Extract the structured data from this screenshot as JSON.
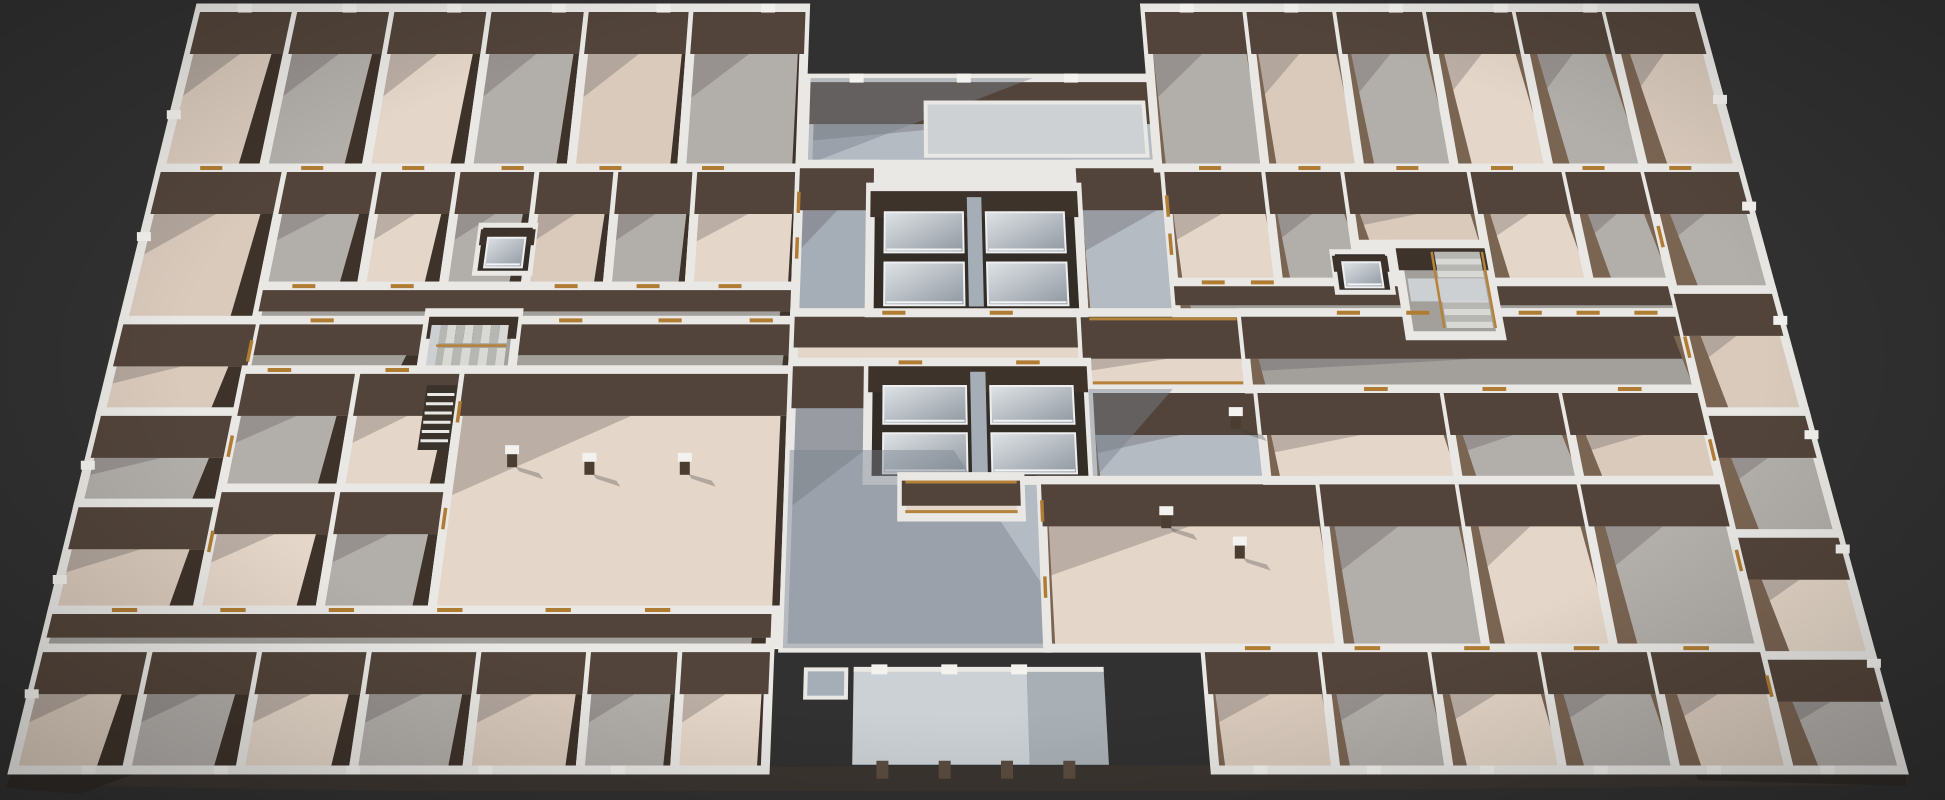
{
  "meta": {
    "view": "3d-floorplan-render",
    "width": 1945,
    "height": 800
  },
  "colors": {
    "bg": "#313131",
    "band": "#e9e8e5",
    "bandBright": "#f3f2ef",
    "slab": "#3b3530",
    "slabDark": "#2e2a26",
    "faceN": "#52443a",
    "faceNDark": "#3d332b",
    "sideL": "#3e332b",
    "sideR": "#7a6452",
    "beige": "#d9cabc",
    "beigeL": "#e4d6c8",
    "gray": "#b2aeaa",
    "grayD": "#a3a09c",
    "lobby": "#b4bbc2",
    "lobbyD": "#a5adb6",
    "sky": "#cdd1d4",
    "canopy": "#ccd1d5",
    "shaft": "#332d28",
    "rail": "#b5823b",
    "oak": "#b07c33",
    "step1": "#d8d8d5",
    "step2": "#b6b6b3",
    "landing": "#cdd0d2",
    "colFace": "#4a3e33",
    "shadow": "rgba(88,82,86,0.30)",
    "lobbyShadow": "rgba(122,130,143,0.45)"
  },
  "proj": {
    "topLeftX": 200,
    "topRightX": 1695,
    "botLeftX": 13,
    "botRightX": 1903,
    "topY": 8,
    "botY": 770,
    "wallH": 42,
    "shearCx": 965,
    "shearK": 0.035,
    "band": 9
  },
  "elements": [
    {
      "t": "spoly",
      "n": "floor-slab-side",
      "f": "slab",
      "pts": [
        [
          13,
          770
        ],
        [
          958,
          766
        ],
        [
          1903,
          763
        ],
        [
          1908,
          785
        ],
        [
          1210,
          791
        ],
        [
          400,
          791
        ],
        [
          12,
          785
        ]
      ]
    },
    {
      "t": "spoly",
      "n": "floor-slab-side-right",
      "f": "slabDark",
      "pts": [
        [
          1690,
          758
        ],
        [
          1903,
          763
        ],
        [
          1907,
          786
        ],
        [
          1698,
          780
        ]
      ]
    },
    {
      "t": "spoly",
      "n": "floor-slab-side-left",
      "f": "slabDark",
      "pts": [
        [
          13,
          768
        ],
        [
          150,
          768
        ],
        [
          80,
          794
        ],
        [
          6,
          788
        ]
      ]
    },
    {
      "t": "fpoly",
      "n": "building-footprint",
      "pts": [
        [
          0,
          0
        ],
        [
          40.5,
          0
        ],
        [
          40.5,
          9.2
        ],
        [
          63.2,
          9.2
        ],
        [
          63.2,
          0
        ],
        [
          100,
          0
        ],
        [
          100,
          100
        ],
        [
          63.6,
          100
        ],
        [
          63.6,
          84
        ],
        [
          39.8,
          84
        ],
        [
          39.8,
          100
        ],
        [
          0,
          100
        ]
      ]
    },
    {
      "t": "room",
      "n": "courtyard",
      "r": [
        41,
        9.2,
        63.2,
        20.5
      ],
      "f": "lobby"
    },
    {
      "t": "shade",
      "n": "courtyard-shadow",
      "pts": [
        [
          41,
          9.2
        ],
        [
          55.5,
          9.2
        ],
        [
          41,
          20.5
        ]
      ],
      "f": "lobbyShadow"
    },
    {
      "t": "rect",
      "n": "courtyard-skylight",
      "r": [
        48.5,
        12.4,
        62.6,
        19.4
      ],
      "f": "sky",
      "ring": 4
    },
    {
      "t": "room",
      "n": "room",
      "r": [
        0,
        0,
        6.5,
        21
      ],
      "f": "beige"
    },
    {
      "t": "room",
      "n": "room",
      "r": [
        6.5,
        0,
        13,
        21
      ],
      "f": "gray"
    },
    {
      "t": "room",
      "n": "room",
      "r": [
        13,
        0,
        19.5,
        21
      ],
      "f": "beigeL"
    },
    {
      "t": "room",
      "n": "room",
      "r": [
        19.5,
        0,
        26,
        21
      ],
      "f": "gray"
    },
    {
      "t": "room",
      "n": "room",
      "r": [
        26,
        0,
        33,
        21
      ],
      "f": "beige"
    },
    {
      "t": "room",
      "n": "room",
      "r": [
        33,
        0,
        40.5,
        21
      ],
      "f": "gray"
    },
    {
      "t": "room",
      "n": "room",
      "r": [
        0,
        21,
        8,
        41
      ],
      "f": "beige"
    },
    {
      "t": "room",
      "n": "room",
      "r": [
        8,
        21,
        14,
        36.5
      ],
      "f": "gray"
    },
    {
      "t": "room",
      "n": "room",
      "r": [
        14,
        21,
        19,
        36.5
      ],
      "f": "beigeL"
    },
    {
      "t": "room",
      "n": "room",
      "r": [
        19,
        21,
        24,
        36.5
      ],
      "f": "gray"
    },
    {
      "t": "room",
      "n": "room",
      "r": [
        24,
        21,
        29,
        36.5
      ],
      "f": "beige"
    },
    {
      "t": "room",
      "n": "room",
      "r": [
        29,
        21,
        34,
        36.5
      ],
      "f": "gray"
    },
    {
      "t": "room",
      "n": "room",
      "r": [
        34,
        21,
        40.5,
        36.5
      ],
      "f": "beigeL"
    },
    {
      "t": "room",
      "n": "corridor",
      "r": [
        8,
        36.5,
        40.5,
        41
      ],
      "f": "grayD"
    },
    {
      "t": "room",
      "n": "corridor",
      "r": [
        8,
        41,
        18.4,
        47.5
      ],
      "f": "grayD"
    },
    {
      "t": "room",
      "n": "corridor",
      "r": [
        23.8,
        41,
        40.5,
        47.5
      ],
      "f": "grayD"
    },
    {
      "t": "stairs",
      "n": "stairwell-west",
      "r": [
        18.4,
        40,
        23.8,
        48
      ],
      "dir": "EW"
    },
    {
      "t": "elev",
      "n": "elevator-west",
      "r": [
        20.8,
        28.5,
        24.2,
        34.8
      ]
    },
    {
      "t": "room",
      "n": "room",
      "r": [
        0,
        41,
        8,
        53
      ],
      "f": "beige"
    },
    {
      "t": "room",
      "n": "room",
      "r": [
        0,
        53,
        8,
        65
      ],
      "f": "gray"
    },
    {
      "t": "room",
      "n": "room",
      "r": [
        0,
        65,
        8,
        79
      ],
      "f": "beige"
    },
    {
      "t": "room",
      "n": "room",
      "r": [
        8,
        47.5,
        14.8,
        63
      ],
      "f": "gray"
    },
    {
      "t": "room",
      "n": "room",
      "r": [
        14.8,
        47.5,
        21,
        63
      ],
      "f": "beigeL"
    },
    {
      "t": "room",
      "n": "room",
      "r": [
        8,
        63,
        14.8,
        79
      ],
      "f": "beigeL"
    },
    {
      "t": "room",
      "n": "room",
      "r": [
        14.8,
        63,
        21,
        79
      ],
      "f": "gray"
    },
    {
      "t": "room",
      "n": "open-plan-room-west",
      "r": [
        21,
        47.5,
        40.5,
        79
      ],
      "f": "beigeL"
    },
    {
      "t": "ladder",
      "n": "service-shaft",
      "r": [
        18.9,
        49.5,
        20.7,
        58
      ]
    },
    {
      "t": "room",
      "n": "corridor",
      "r": [
        0,
        79,
        39.8,
        84
      ],
      "f": "grayD"
    },
    {
      "t": "room",
      "n": "room",
      "r": [
        0,
        84,
        6,
        100
      ],
      "f": "beige"
    },
    {
      "t": "room",
      "n": "room",
      "r": [
        6,
        84,
        12,
        100
      ],
      "f": "gray"
    },
    {
      "t": "room",
      "n": "room",
      "r": [
        12,
        84,
        18,
        100
      ],
      "f": "beigeL"
    },
    {
      "t": "room",
      "n": "room",
      "r": [
        18,
        84,
        24,
        100
      ],
      "f": "gray"
    },
    {
      "t": "room",
      "n": "room",
      "r": [
        24,
        84,
        30,
        100
      ],
      "f": "beige"
    },
    {
      "t": "room",
      "n": "room",
      "r": [
        30,
        84,
        35,
        100
      ],
      "f": "gray"
    },
    {
      "t": "room",
      "n": "room",
      "r": [
        35,
        84,
        39.8,
        100
      ],
      "f": "beigeL"
    },
    {
      "t": "room",
      "n": "lobby-strip-west",
      "r": [
        40.5,
        20.5,
        45.2,
        40
      ],
      "f": "lobbyD"
    },
    {
      "t": "room",
      "n": "lobby-strip-east",
      "r": [
        58,
        20.5,
        67.5,
        40
      ],
      "f": "lobby"
    },
    {
      "t": "room",
      "n": "core-corridor",
      "r": [
        40.5,
        40,
        57.8,
        46.5
      ],
      "f": "beigeL"
    },
    {
      "t": "room",
      "n": "bridge-corridor",
      "r": [
        57.8,
        40,
        67.5,
        50
      ],
      "f": "beigeL"
    },
    {
      "t": "core",
      "n": "elevator-core-north",
      "r": [
        45,
        23.5,
        58,
        40
      ]
    },
    {
      "t": "room",
      "n": "lobby-main",
      "r": [
        40.5,
        46.5,
        55,
        84
      ],
      "f": "lobby"
    },
    {
      "t": "room",
      "n": "lobby-east-pool",
      "r": [
        58,
        50,
        68,
        62
      ],
      "f": "lobby"
    },
    {
      "t": "core",
      "n": "elevator-core-south",
      "r": [
        45,
        46.5,
        58,
        62
      ]
    },
    {
      "t": "shade",
      "n": "lobby-shadow",
      "pts": [
        [
          40.5,
          58
        ],
        [
          50,
          58
        ],
        [
          57,
          84
        ],
        [
          40.5,
          84
        ]
      ],
      "f": "lobbyShadow"
    },
    {
      "t": "shade",
      "n": "lobby-shadow-2",
      "pts": [
        [
          58,
          50
        ],
        [
          63,
          50
        ],
        [
          58,
          62
        ]
      ],
      "f": "lobbyShadow"
    },
    {
      "t": "room",
      "n": "walkway",
      "r": [
        47,
        61.5,
        53.8,
        66.8
      ],
      "f": "beigeL"
    },
    {
      "t": "room",
      "n": "open-plan-room-center",
      "r": [
        55,
        62,
        71,
        84
      ],
      "f": "beigeL"
    },
    {
      "t": "room",
      "n": "room",
      "r": [
        63.2,
        0,
        70,
        21
      ],
      "f": "gray"
    },
    {
      "t": "room",
      "n": "room",
      "r": [
        70,
        0,
        76,
        21
      ],
      "f": "beige"
    },
    {
      "t": "room",
      "n": "room",
      "r": [
        76,
        0,
        82,
        21
      ],
      "f": "gray"
    },
    {
      "t": "room",
      "n": "room",
      "r": [
        82,
        0,
        88,
        21
      ],
      "f": "beigeL"
    },
    {
      "t": "room",
      "n": "room",
      "r": [
        88,
        0,
        94,
        21
      ],
      "f": "gray"
    },
    {
      "t": "room",
      "n": "room",
      "r": [
        94,
        0,
        100,
        21
      ],
      "f": "beige"
    },
    {
      "t": "room",
      "n": "room",
      "r": [
        63.6,
        21,
        70,
        36
      ],
      "f": "beigeL"
    },
    {
      "t": "room",
      "n": "room",
      "r": [
        70,
        21,
        75,
        36
      ],
      "f": "gray"
    },
    {
      "t": "room",
      "n": "room",
      "r": [
        75,
        21,
        83,
        31
      ],
      "f": "beige"
    },
    {
      "t": "room",
      "n": "room",
      "r": [
        83,
        21,
        89,
        36
      ],
      "f": "beigeL"
    },
    {
      "t": "room",
      "n": "room",
      "r": [
        89,
        21,
        94,
        36
      ],
      "f": "gray"
    },
    {
      "t": "room",
      "n": "corridor",
      "r": [
        63.6,
        36,
        94,
        40
      ],
      "f": "grayD"
    },
    {
      "t": "room",
      "n": "corridor",
      "r": [
        67.5,
        40,
        94,
        50
      ],
      "f": "grayD"
    },
    {
      "t": "stairs",
      "n": "stairwell-east",
      "r": [
        77.5,
        31,
        83,
        43
      ],
      "dir": "NS"
    },
    {
      "t": "elev",
      "n": "elevator-east",
      "r": [
        73.5,
        32,
        76.9,
        37.3
      ]
    },
    {
      "t": "room",
      "n": "room",
      "r": [
        94,
        21,
        100,
        37
      ],
      "f": "gray"
    },
    {
      "t": "room",
      "n": "room",
      "r": [
        94,
        37,
        100,
        53
      ],
      "f": "beige"
    },
    {
      "t": "room",
      "n": "room",
      "r": [
        94,
        53,
        100,
        69
      ],
      "f": "gray"
    },
    {
      "t": "room",
      "n": "room",
      "r": [
        94,
        69,
        100,
        85
      ],
      "f": "beigeL"
    },
    {
      "t": "room",
      "n": "room",
      "r": [
        94,
        85,
        100,
        100
      ],
      "f": "gray"
    },
    {
      "t": "room",
      "n": "room",
      "r": [
        68,
        50,
        79,
        62
      ],
      "f": "beigeL"
    },
    {
      "t": "room",
      "n": "room",
      "r": [
        79,
        50,
        86,
        62
      ],
      "f": "gray"
    },
    {
      "t": "room",
      "n": "room",
      "r": [
        86,
        50,
        94,
        62
      ],
      "f": "beige"
    },
    {
      "t": "room",
      "n": "room",
      "r": [
        71,
        62,
        79,
        84
      ],
      "f": "gray"
    },
    {
      "t": "room",
      "n": "room",
      "r": [
        79,
        62,
        86,
        84
      ],
      "f": "beigeL"
    },
    {
      "t": "room",
      "n": "room",
      "r": [
        86,
        62,
        94,
        84
      ],
      "f": "gray"
    },
    {
      "t": "room",
      "n": "room",
      "r": [
        63.6,
        84,
        70,
        100
      ],
      "f": "beige"
    },
    {
      "t": "room",
      "n": "room",
      "r": [
        70,
        84,
        76,
        100
      ],
      "f": "gray"
    },
    {
      "t": "room",
      "n": "room",
      "r": [
        76,
        84,
        82,
        100
      ],
      "f": "beigeL"
    },
    {
      "t": "room",
      "n": "room",
      "r": [
        82,
        84,
        88,
        100
      ],
      "f": "gray"
    },
    {
      "t": "room",
      "n": "room",
      "r": [
        88,
        84,
        94,
        100
      ],
      "f": "beige"
    },
    {
      "t": "canopy",
      "n": "entrance-canopy",
      "r": [
        44.4,
        86.8,
        58,
        99.3
      ],
      "nubs": [
        45.8,
        49.6,
        53.4
      ],
      "cols": [
        46,
        49.3,
        52.6,
        55.9
      ]
    },
    {
      "t": "rect",
      "n": "entrance-pad",
      "r": [
        41.8,
        86.8,
        44,
        90.5
      ],
      "f": "lobbyD",
      "ring": 4
    },
    {
      "t": "doors"
    },
    {
      "t": "nubs"
    },
    {
      "t": "cols"
    },
    {
      "t": "rails"
    }
  ],
  "doors": [
    [
      "h",
      3.2,
      21
    ],
    [
      "h",
      9.6,
      21
    ],
    [
      "h",
      16,
      21
    ],
    [
      "h",
      22.3,
      21
    ],
    [
      "h",
      28.5,
      21
    ],
    [
      "h",
      35,
      21
    ],
    [
      "h",
      66.5,
      21
    ],
    [
      "h",
      72.8,
      21
    ],
    [
      "h",
      79,
      21
    ],
    [
      "h",
      85,
      21
    ],
    [
      "h",
      90.8,
      21
    ],
    [
      "h",
      96.3,
      21
    ],
    [
      "h",
      10.5,
      36.5
    ],
    [
      "h",
      16.5,
      36.5
    ],
    [
      "h",
      26.5,
      36.5
    ],
    [
      "h",
      31.5,
      36.5
    ],
    [
      "h",
      36.5,
      36.5
    ],
    [
      "h",
      12,
      41
    ],
    [
      "h",
      27,
      41
    ],
    [
      "h",
      33,
      41
    ],
    [
      "h",
      38.5,
      41
    ],
    [
      "h",
      10,
      47.5
    ],
    [
      "h",
      17,
      47.5
    ],
    [
      "h",
      66,
      36
    ],
    [
      "h",
      69,
      36
    ],
    [
      "h",
      74,
      40
    ],
    [
      "h",
      78.2,
      40
    ],
    [
      "h",
      85,
      40
    ],
    [
      "h",
      88.5,
      40
    ],
    [
      "h",
      92,
      40
    ],
    [
      "h",
      75,
      50
    ],
    [
      "h",
      82,
      50
    ],
    [
      "h",
      90,
      50
    ],
    [
      "h",
      4,
      79
    ],
    [
      "h",
      10,
      79
    ],
    [
      "h",
      16,
      79
    ],
    [
      "h",
      22,
      79
    ],
    [
      "h",
      28,
      79
    ],
    [
      "h",
      33.5,
      79
    ],
    [
      "h",
      66.5,
      84
    ],
    [
      "h",
      72.5,
      84
    ],
    [
      "h",
      78.5,
      84
    ],
    [
      "h",
      84.5,
      84
    ],
    [
      "h",
      90.5,
      84
    ],
    [
      "h",
      46.5,
      40
    ],
    [
      "h",
      53,
      40
    ],
    [
      "h",
      47.5,
      46.5
    ],
    [
      "h",
      54.5,
      46.5
    ],
    [
      "v",
      8,
      45
    ],
    [
      "v",
      8,
      57.5
    ],
    [
      "v",
      8,
      70
    ],
    [
      "v",
      94,
      30
    ],
    [
      "v",
      94,
      44.5
    ],
    [
      "v",
      94,
      58
    ],
    [
      "v",
      94,
      72.5
    ],
    [
      "v",
      94,
      89
    ],
    [
      "v",
      21,
      53
    ],
    [
      "v",
      21,
      67
    ],
    [
      "v",
      40.5,
      25.5
    ],
    [
      "v",
      40.5,
      31.5
    ],
    [
      "v",
      55,
      66
    ],
    [
      "v",
      55,
      76
    ],
    [
      "v",
      63.6,
      26
    ],
    [
      "v",
      63.6,
      31
    ]
  ],
  "nubs": [
    [
      3,
      0
    ],
    [
      10,
      0
    ],
    [
      17,
      0
    ],
    [
      24,
      0
    ],
    [
      31,
      0
    ],
    [
      38,
      0
    ],
    [
      66,
      0
    ],
    [
      73,
      0
    ],
    [
      80,
      0
    ],
    [
      87,
      0
    ],
    [
      93,
      0
    ],
    [
      44,
      9.2
    ],
    [
      51,
      9.2
    ],
    [
      58,
      9.2
    ],
    [
      0,
      14
    ],
    [
      0,
      30
    ],
    [
      0,
      60
    ],
    [
      0,
      75
    ],
    [
      0,
      90
    ],
    [
      100,
      12
    ],
    [
      100,
      26
    ],
    [
      100,
      41
    ],
    [
      100,
      56
    ],
    [
      100,
      71
    ],
    [
      100,
      86
    ],
    [
      4,
      100
    ],
    [
      11,
      100
    ],
    [
      18,
      100
    ],
    [
      25,
      100
    ],
    [
      32,
      100
    ],
    [
      66,
      100
    ],
    [
      72,
      100
    ],
    [
      78,
      100
    ],
    [
      84,
      100
    ],
    [
      90,
      100
    ],
    [
      96,
      100
    ]
  ],
  "columns": [
    [
      24.5,
      60
    ],
    [
      29,
      61
    ],
    [
      34.5,
      61
    ],
    [
      62,
      68
    ],
    [
      66,
      72
    ],
    [
      66.5,
      55
    ]
  ],
  "rails": [
    [
      [
        58.3,
        40.8
      ],
      [
        67.2,
        40.8
      ]
    ],
    [
      [
        58.3,
        49.2
      ],
      [
        67.2,
        49.2
      ]
    ],
    [
      [
        47.2,
        62.2
      ],
      [
        53.6,
        62.2
      ]
    ],
    [
      [
        47.2,
        66.1
      ],
      [
        53.6,
        66.1
      ]
    ]
  ]
}
